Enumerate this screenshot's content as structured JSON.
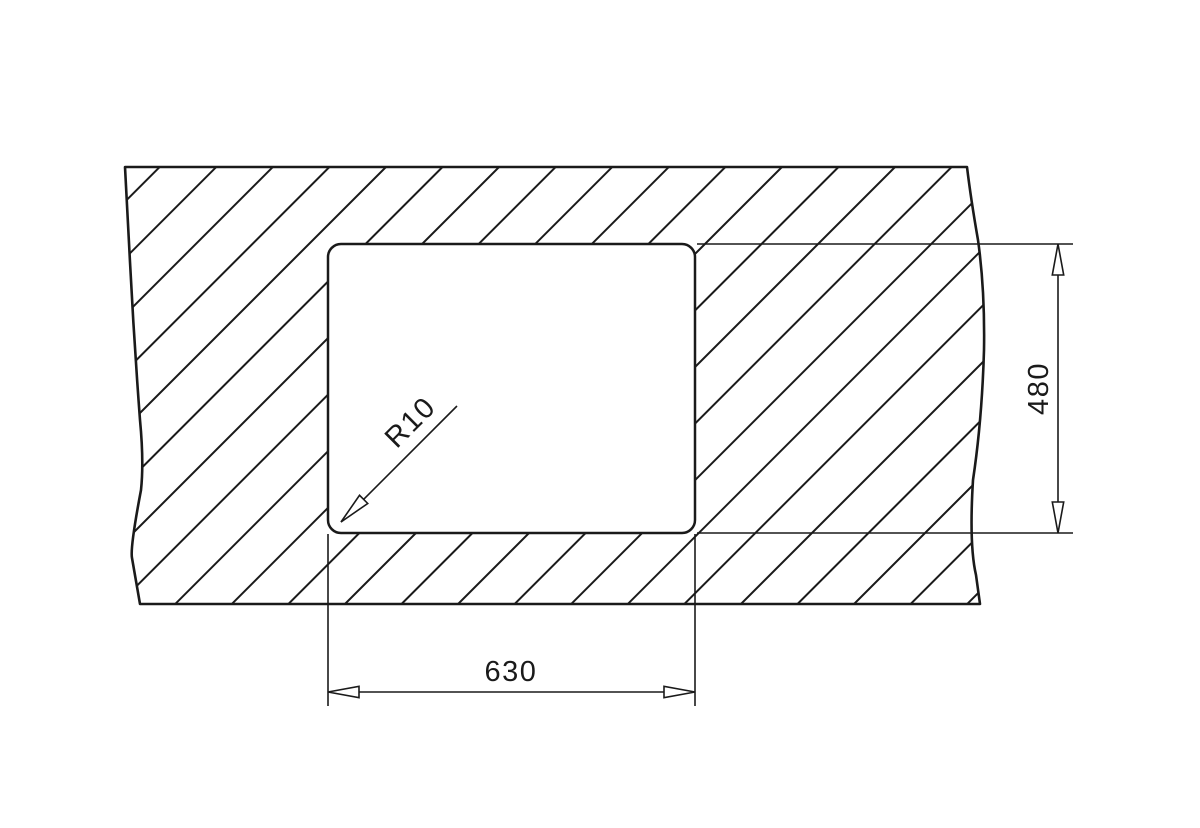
{
  "page": {
    "title": "Sink cutout dimension drawing",
    "background_color": "#ffffff",
    "line_color": "#1a1a1a"
  },
  "drawing": {
    "kind": "technical-dimension-drawing",
    "subject": "worktop-cutout",
    "width_dimension": {
      "label": "630"
    },
    "height_dimension": {
      "label": "480"
    },
    "corner_radius_callout": {
      "label": "R10"
    }
  }
}
